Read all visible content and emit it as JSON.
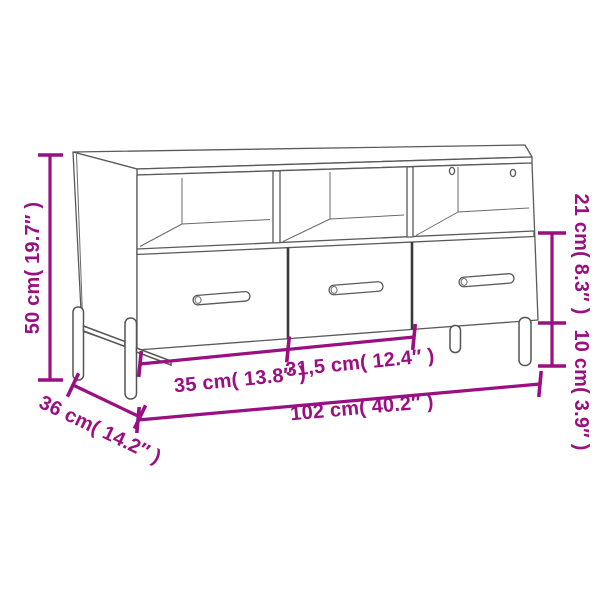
{
  "page": {
    "type": "product-dimension-diagram",
    "background_color": "#ffffff"
  },
  "product": {
    "name": "TV cabinet line drawing",
    "style": "3D perspective line art",
    "open_compartments": 3,
    "drawers": 3,
    "cable_holes_in_right_compartment": 2,
    "legs_visible": 4
  },
  "colors": {
    "dimension_accent": "#9a0f81",
    "furniture_outline": "#5a5a5a",
    "furniture_outline_dark": "#3a3a3a"
  },
  "dimensions": {
    "overall_height": "50 cm( 19.7″ )",
    "drawer_section_height": "21 cm( 8.3″ )",
    "leg_height": "10 cm( 3.9″ )",
    "left_drawer_width": "35 cm( 13.8″ )",
    "middle_drawer_width": "31,5 cm( 12.4″ )",
    "overall_width": "102 cm( 40.2″ )",
    "depth": "36 cm( 14.2″ )"
  }
}
